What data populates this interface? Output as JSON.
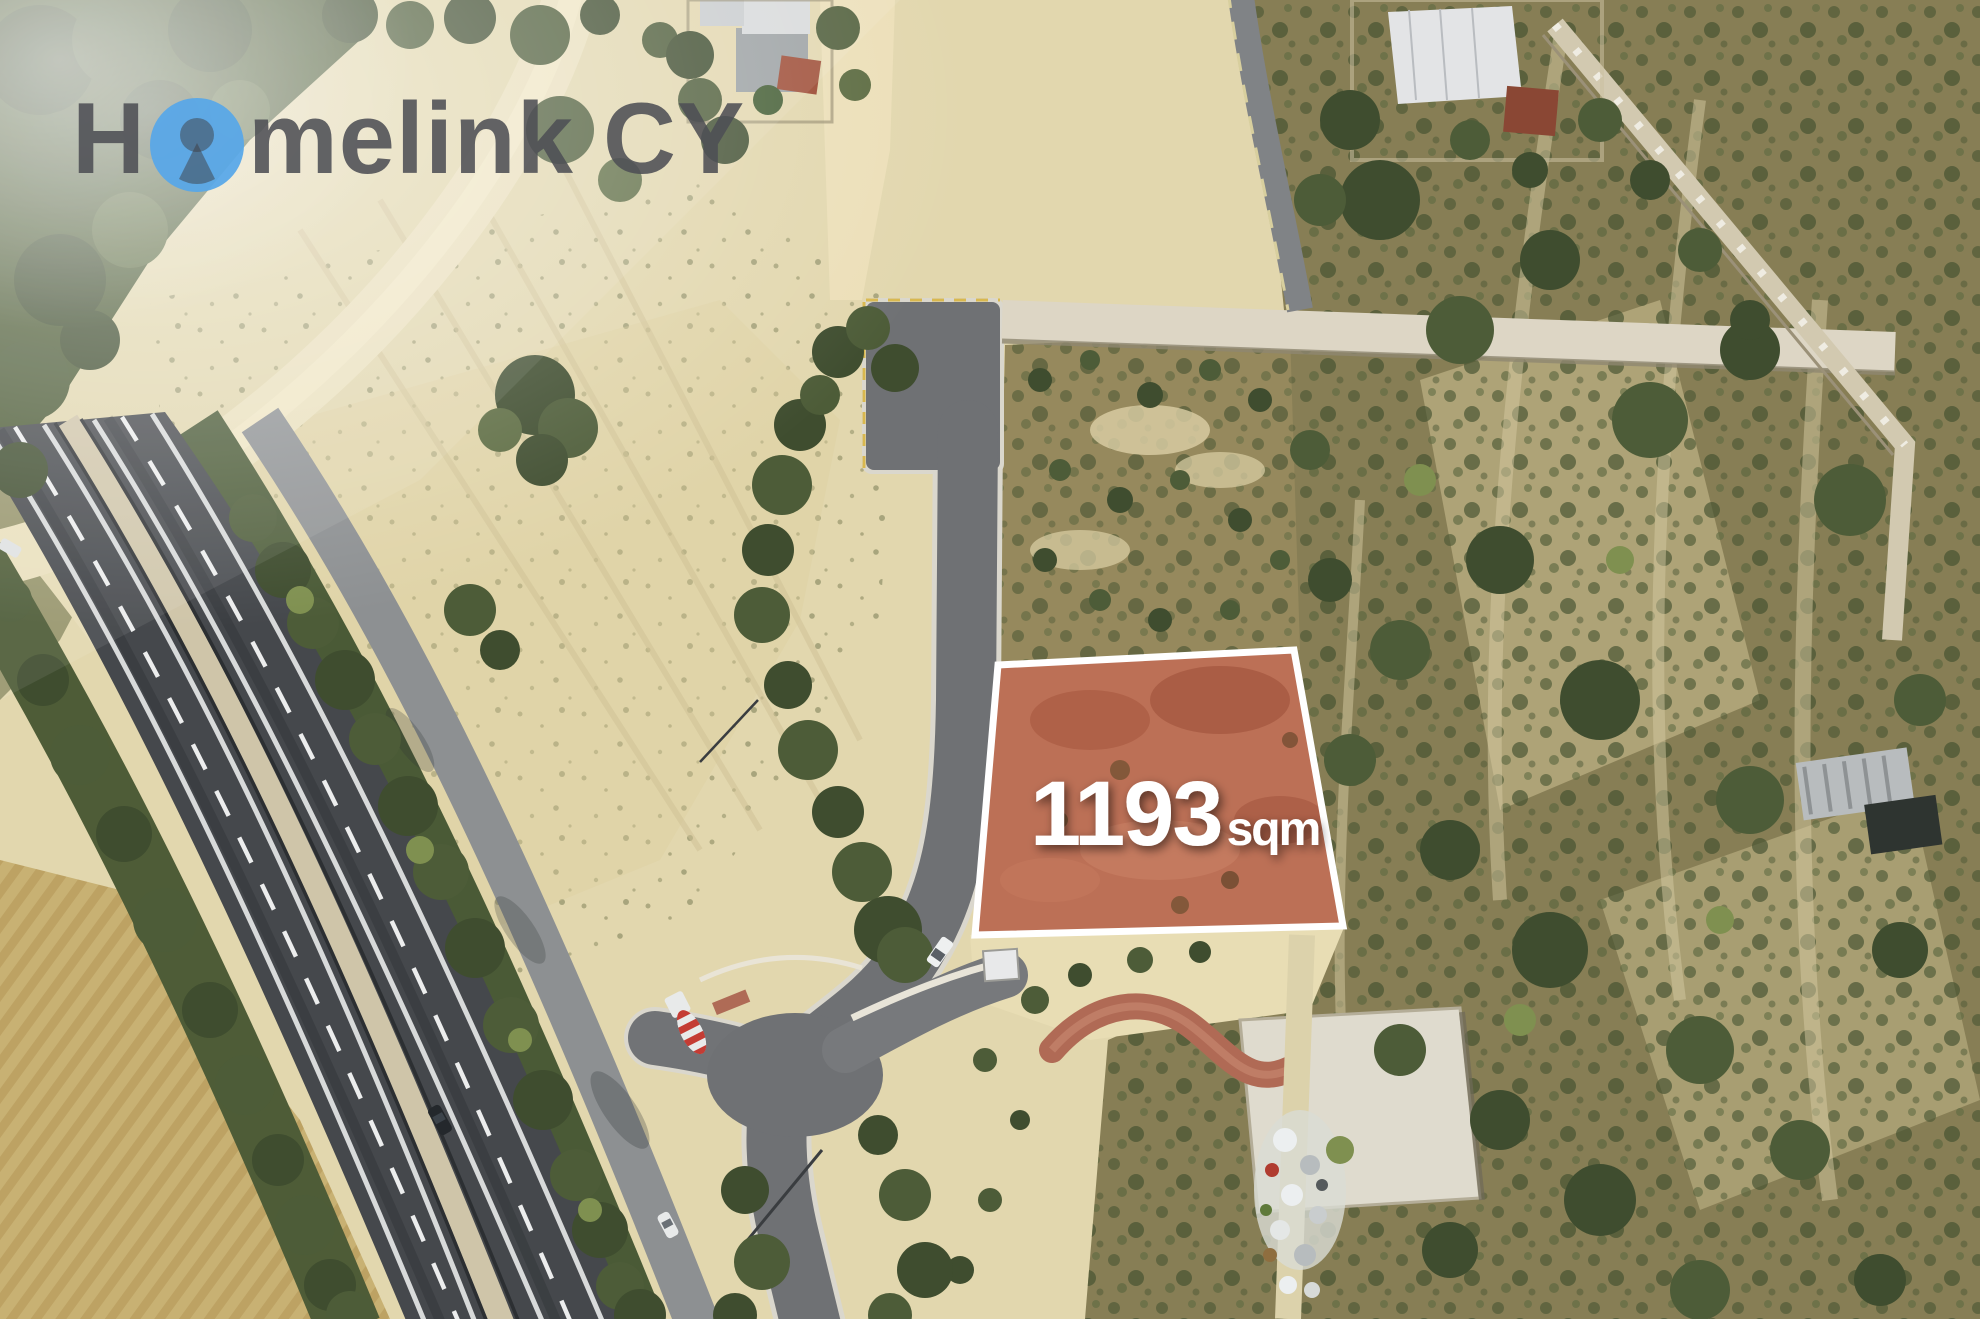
{
  "watermark": {
    "prefix": "H",
    "suffix": "melink CY",
    "icon": "keyhole-icon",
    "text_color": "#4d4f54",
    "icon_blue": "#57a7e8"
  },
  "plot_label": {
    "area": "1193",
    "unit": "sqm",
    "color": "#ffffff"
  },
  "plot": {
    "outline_color": "#ffffff",
    "highlight_fill": "rgba(190,45,25,0.28)"
  }
}
